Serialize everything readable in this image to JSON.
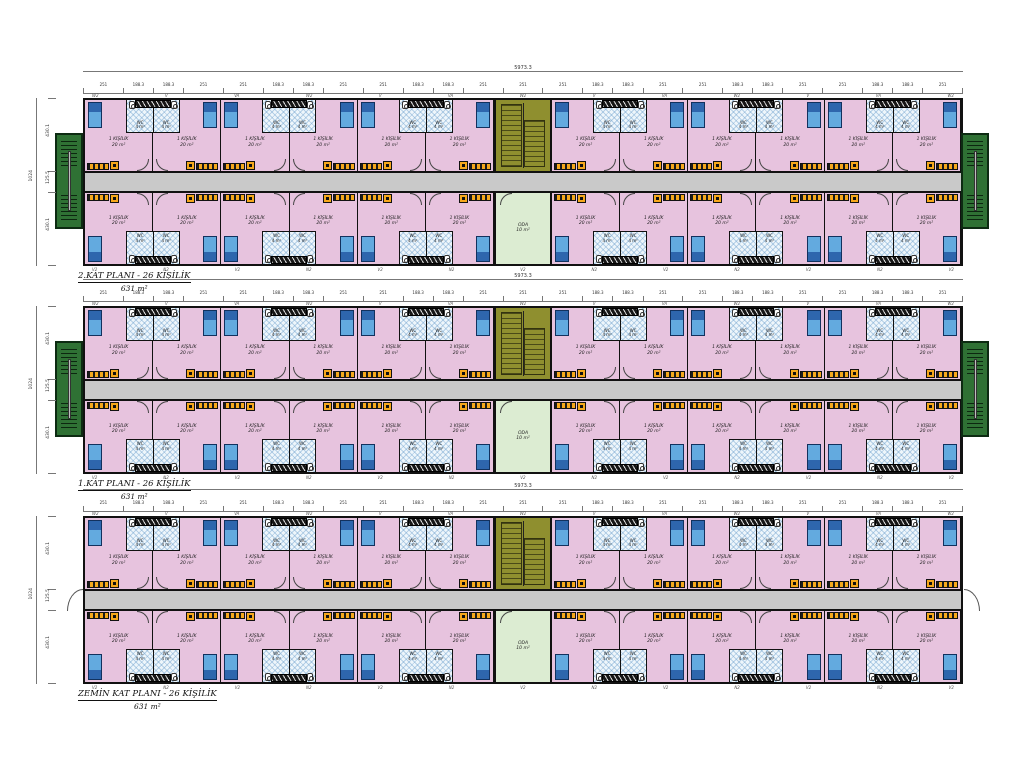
{
  "drawing_title": "Dormitory container building floor plans",
  "floors": [
    {
      "label": "2.KAT PLANI - 26 KİŞİLİK",
      "area": "631 m²",
      "has_side_stairs": true
    },
    {
      "label": "1.KAT PLANI - 26 KİŞİLİK",
      "area": "631 m²",
      "has_side_stairs": true
    },
    {
      "label": "ZEMİN KAT PLANI - 26 KİŞİLİK",
      "area": "631 m²",
      "has_side_stairs": false
    }
  ],
  "dimensions": {
    "overall_width": "5973.3",
    "overall_height": "1024",
    "top_pattern": [
      "251",
      "188.3",
      "188.3",
      "251"
    ],
    "top_repeat": 6,
    "center_segment": "251",
    "left_segments": [
      "430.1",
      "125.5",
      "430.1"
    ]
  },
  "room": {
    "label": "1 KİŞİLİK",
    "area": "20 m²"
  },
  "wc": {
    "label": "WC",
    "area": "4 m²"
  },
  "oda": {
    "label": "ODA",
    "area": "10 m²"
  },
  "wall_tags_top": [
    "W2",
    "V",
    "VA"
  ],
  "wall_tags_bottom": [
    "V2",
    "N2"
  ],
  "colors": {
    "room_pink": "#e7c3de",
    "bed_blue": "#63aadf",
    "bed_dark_blue": "#2e66ad",
    "wc_hatch_blue": "#eef6fb",
    "corridor_gray": "#c9c9c9",
    "stair_olive": "#8f8f2f",
    "oda_green": "#dcecd2",
    "tower_green": "#2f7134",
    "furniture_orange": "#f6a81c",
    "wall_black": "#111111"
  }
}
